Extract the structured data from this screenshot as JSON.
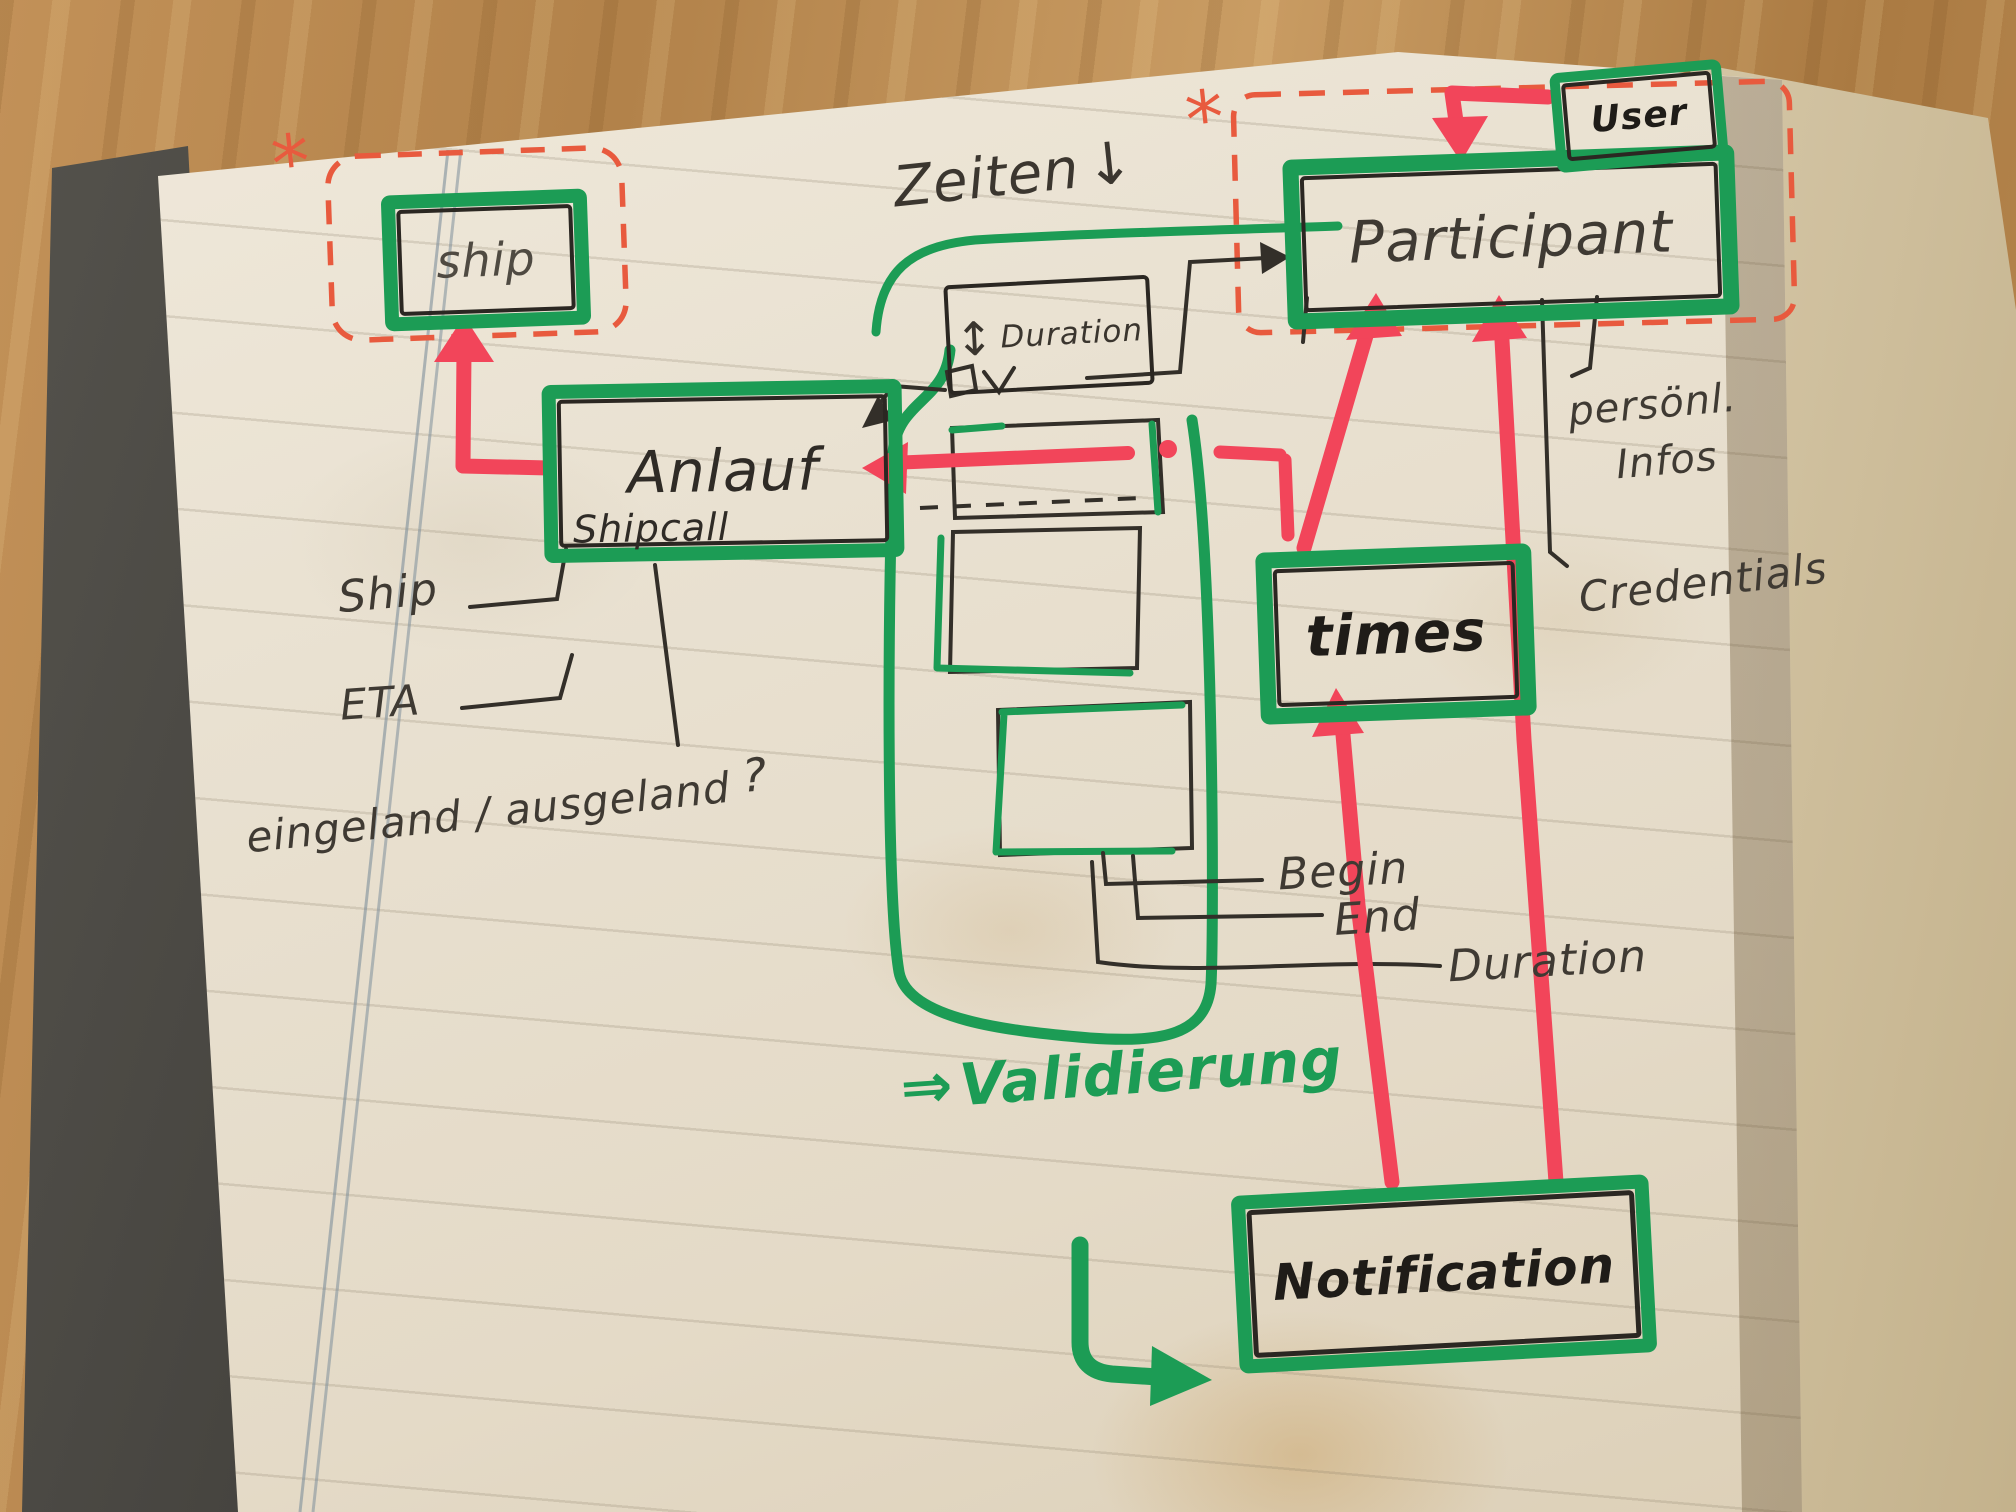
{
  "colors": {
    "green": "#1c9c55",
    "red": "#f2455a",
    "dashed_red": "#e85a3e",
    "ink": "#332f29"
  },
  "boxes": {
    "ship": {
      "label": "ship"
    },
    "anlauf": {
      "label": "Anlauf",
      "sublabel": "Shipcall"
    },
    "duration": {
      "updown_arrow": "↕",
      "label": "Duration"
    },
    "participant": {
      "label": "Participant"
    },
    "user": {
      "label": "User"
    },
    "times": {
      "label": "times"
    },
    "notification": {
      "label": "Notification"
    }
  },
  "annotations": {
    "zeiten": {
      "text": "Zeiten",
      "down_arrow": "↓"
    },
    "asterisk_ship": "*",
    "asterisk_participant": "*",
    "ship_attr": "Ship",
    "eta": "ETA",
    "inout": "eingeland / ausgeland",
    "inout_question": "?",
    "persoenl_line1": "persönl.",
    "persoenl_line2": "Infos",
    "credentials": "Credentials",
    "begin": "Begin",
    "end": "End",
    "duration_attr": "Duration",
    "validierung": {
      "arrow": "⇒",
      "text": "Validierung"
    }
  }
}
